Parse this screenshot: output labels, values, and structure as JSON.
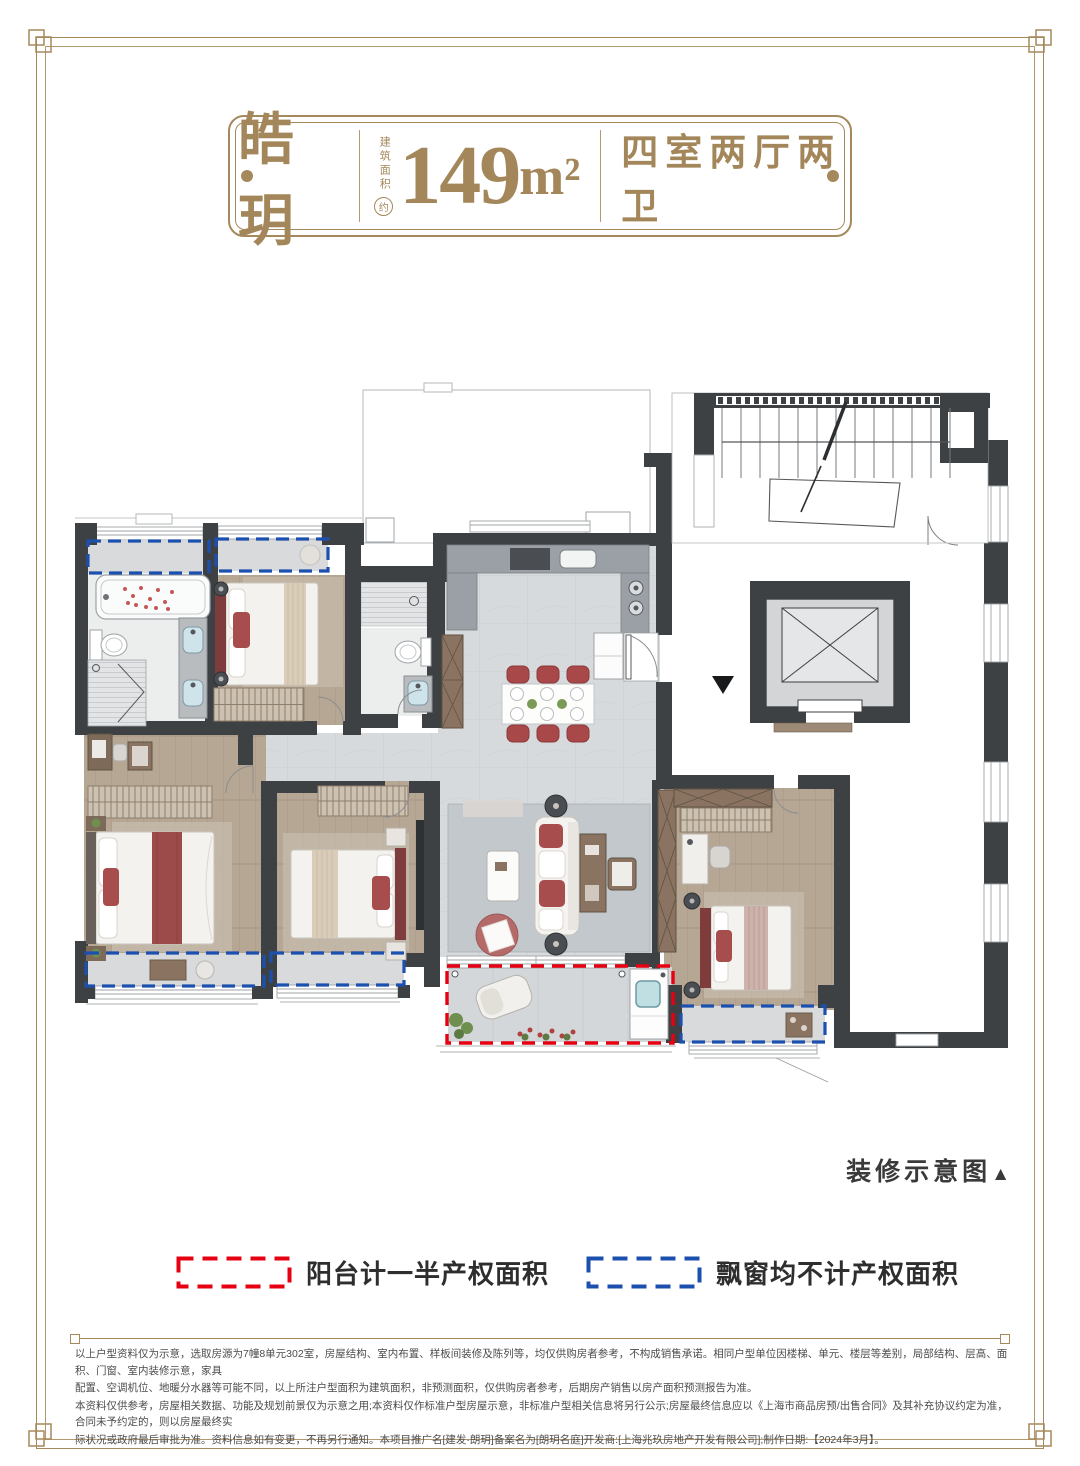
{
  "page": {
    "bg": "#ffffff",
    "border_color": "#a5895c"
  },
  "header": {
    "name": "皓玥",
    "area_prefix_vertical": "建筑面积",
    "area_prefix_circled": "约",
    "area_value": "149",
    "area_unit": "m²",
    "layout": "四室两厅两卫"
  },
  "floorplan": {
    "note": "装修示意图",
    "note_marker": "▲",
    "entry_marker": "▼",
    "colors": {
      "wall": "#3e4144",
      "wood_floor": "#b6a794",
      "marble_floor": "#d7dadc",
      "balcony_dash_red": "#e60012",
      "bay_window_dash_blue": "#1c50ae",
      "furniture_accent_red": "#a84d4d"
    }
  },
  "legend": {
    "items": [
      {
        "label": "阳台计一半产权面积",
        "color": "#e60012"
      },
      {
        "label": "飘窗均不计产权面积",
        "color": "#1c50ae"
      }
    ]
  },
  "disclaimer": {
    "lines": [
      "以上户型资料仅为示意，选取房源为7幢8单元302室，房屋结构、室内布置、样板间装修及陈列等，均仅供购房者参考，不构成销售承诺。相同户型单位因楼梯、单元、楼层等差别，局部结构、层高、面积、门窗、室内装修示意，家具",
      "配置、空调机位、地暖分水器等可能不同，以上所注户型面积为建筑面积，非预测面积，仅供购房者参考，后期房产销售以房产面积预测报告为准。",
      "本资料仅供参考，房屋相关数据、功能及规划前景仅为示意之用;本资料仅作标准户型房屋示意，非标准户型相关信息将另行公示;房屋最终信息应以《上海市商品房预/出售合同》及其补充协议约定为准，合同未予约定的，则以房屋最终实",
      "际状况或政府最后审批为准。资料信息如有变更，不再另行通知。本项目推广名[建发·朗玥]备案名为[朗玥名庭]开发商:[上海兆玖房地产开发有限公司];制作日期:【2024年3月】。"
    ]
  }
}
